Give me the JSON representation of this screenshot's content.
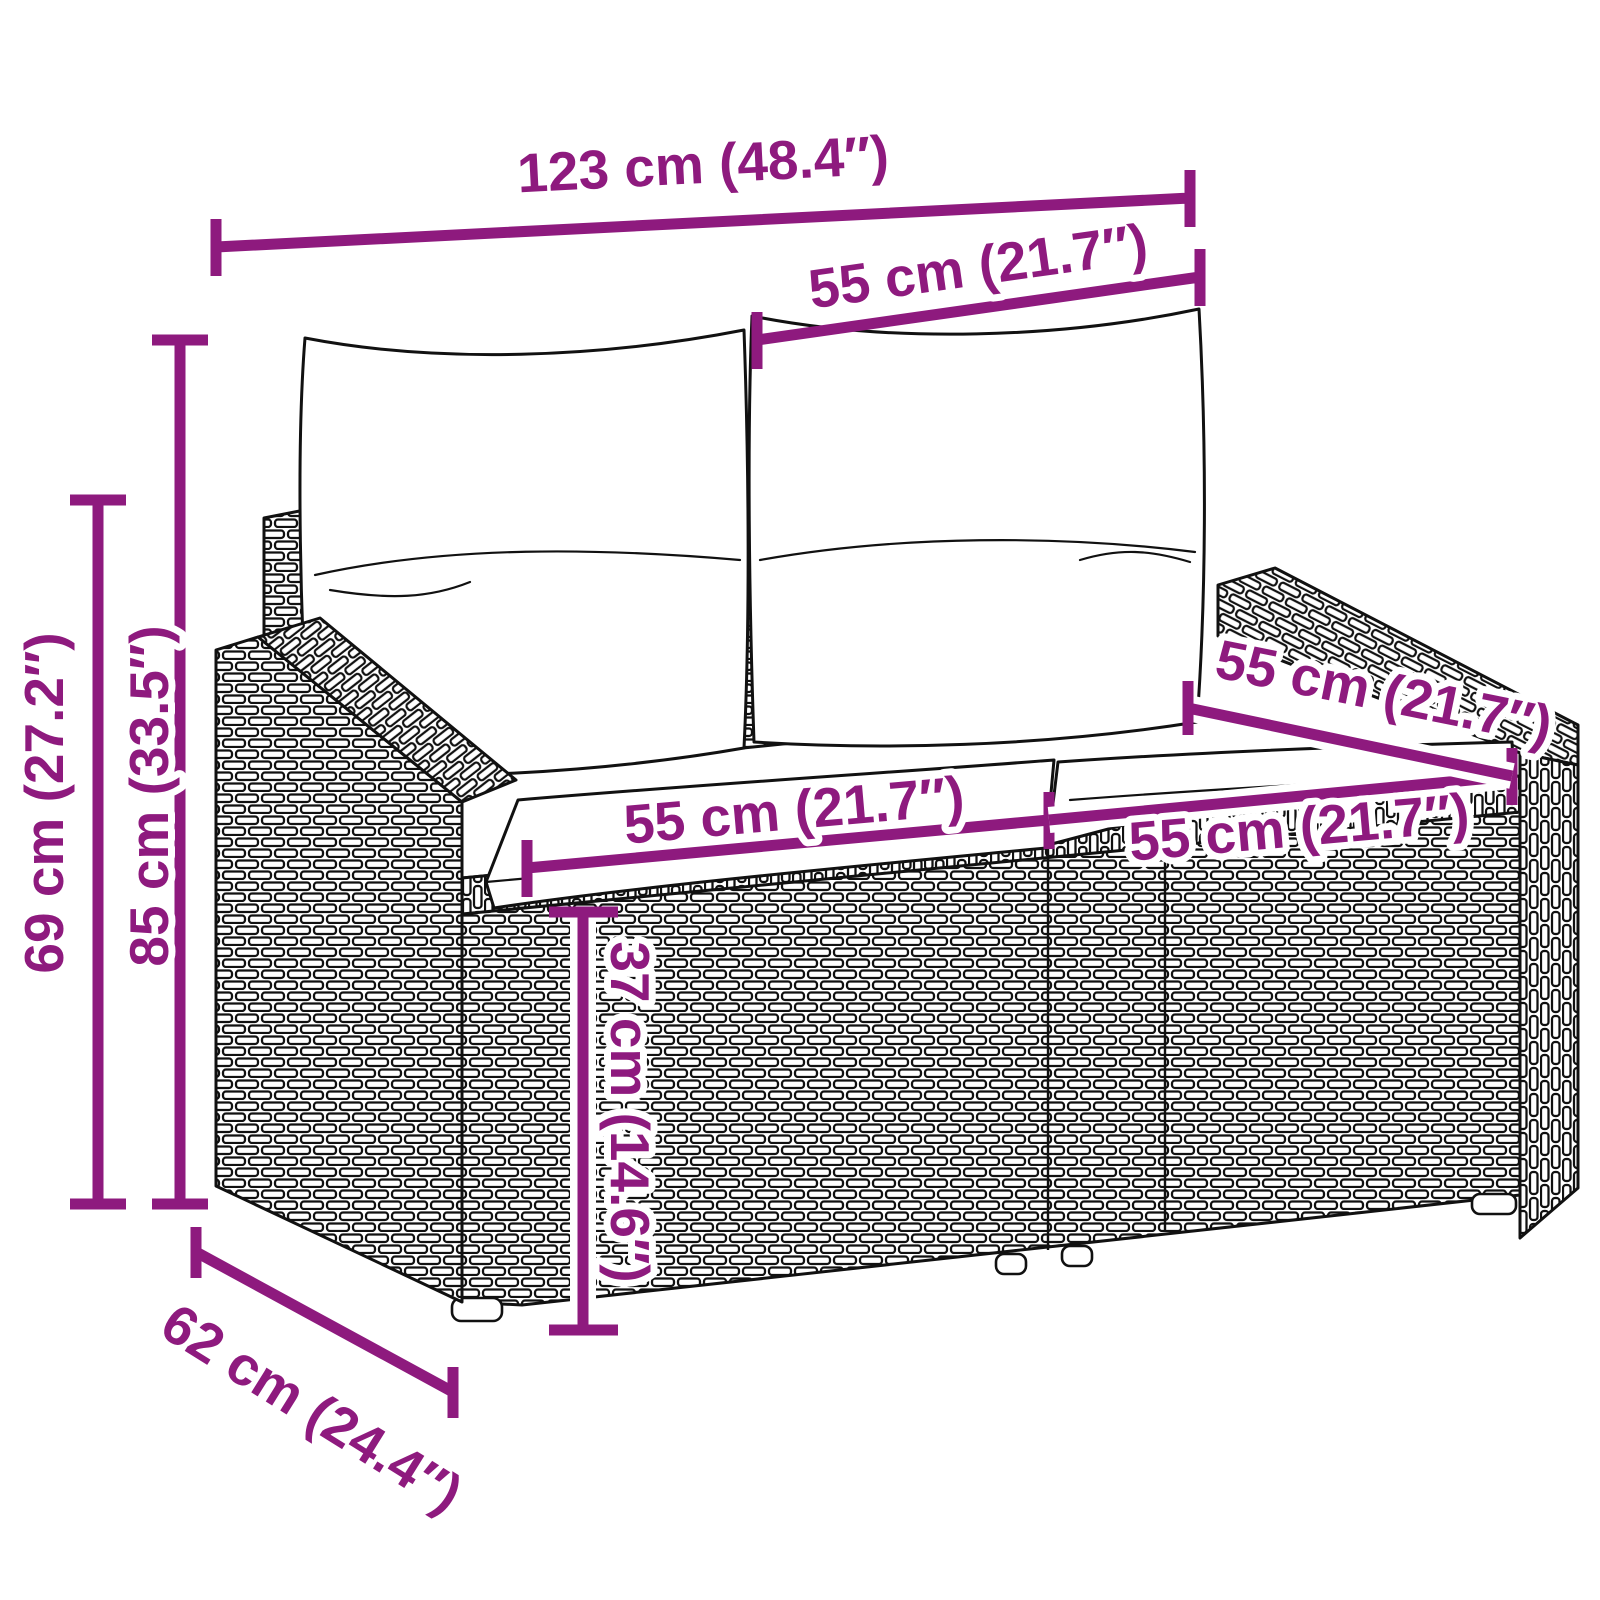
{
  "diagram": {
    "type": "product-dimension-diagram",
    "subject": "rattan-2-seater-garden-sofa-with-cushions",
    "accent_color": "#8e1a7e",
    "line_color": "#111111",
    "background": "#ffffff",
    "annotations": {
      "overall_width": "123 cm (48.4″)",
      "back_cushion_width": "55 cm (21.7″)",
      "overall_height": "85 cm (33.5″)",
      "frame_height": "69 cm (27.2″)",
      "seat_width_left": "55 cm (21.7″)",
      "seat_width_right": "55 cm (21.7″)",
      "seat_depth": "55 cm (21.7″)",
      "seat_height": "37 cm (14.6″)",
      "overall_depth": "62 cm (24.4″)"
    }
  }
}
